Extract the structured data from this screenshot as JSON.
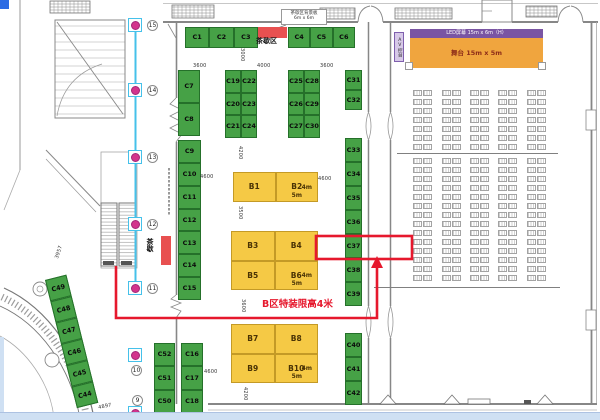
{
  "note_box": {
    "line1": "茶歇区背景板",
    "line2": "6m x 6m"
  },
  "labels": {
    "tea_area": "茶歇区",
    "tea_side": "茶歇",
    "limit": "B区特装限高4米",
    "led": "LED屏幕 15m x 6m（H）",
    "stage": "舞台 15m x 5m",
    "av_console": "AV控台"
  },
  "booth_groups": [
    {
      "id": "c1-3",
      "cells": [
        "C1",
        "C2",
        "C3"
      ]
    },
    {
      "id": "c4-6",
      "cells": [
        "C4",
        "C5",
        "C6"
      ]
    },
    {
      "id": "c7-8",
      "cells": [
        "C7",
        "C8"
      ]
    },
    {
      "id": "c19-24",
      "cells": [
        "C19",
        "C22",
        "C20",
        "C23",
        "C21",
        "C24"
      ]
    },
    {
      "id": "c25-30",
      "cells": [
        "C25",
        "C28",
        "C26",
        "C29",
        "C27",
        "C30"
      ]
    },
    {
      "id": "c31-32",
      "cells": [
        "C31",
        "C32"
      ]
    },
    {
      "id": "c9-15",
      "cells": [
        "C9",
        "C10",
        "C11",
        "C12",
        "C13",
        "C14",
        "C15"
      ]
    },
    {
      "id": "c33-39",
      "cells": [
        "C33",
        "C34",
        "C35",
        "C36",
        "C37",
        "C38",
        "C39"
      ]
    },
    {
      "id": "c40-42",
      "cells": [
        "C40",
        "C41",
        "C42"
      ]
    },
    {
      "id": "c52-50",
      "cells": [
        "C52",
        "C51",
        "C50"
      ]
    },
    {
      "id": "c16-18",
      "cells": [
        "C16",
        "C17",
        "C18"
      ]
    },
    {
      "id": "c49-44",
      "cells": [
        "C49",
        "C48",
        "C47",
        "C46",
        "C45",
        "C44"
      ]
    },
    {
      "id": "b1-2",
      "cells": [
        "B1",
        "B2"
      ],
      "size_labels": [
        "4m",
        "5m"
      ]
    },
    {
      "id": "b3-6",
      "cells": [
        "B3",
        "B4",
        "B5",
        "B6"
      ],
      "size_labels": [
        "4m",
        "5m"
      ]
    },
    {
      "id": "b7-10",
      "cells": [
        "B7",
        "B8",
        "B9",
        "B10"
      ],
      "size_labels": [
        "4m",
        "5m"
      ]
    }
  ],
  "markers": [
    "15",
    "14",
    "13",
    "12",
    "11",
    "10",
    "9"
  ],
  "dimensions": [
    "3600",
    "3000",
    "4000",
    "3600",
    "4200",
    "4600",
    "4600",
    "3500",
    "3600",
    "4600",
    "4200",
    "3957",
    "4897"
  ],
  "seating": {
    "column_groups": 5,
    "chairs_per_group": 2,
    "upper_rows": 7,
    "lower_rows": 14
  },
  "colors": {
    "booth_green": "#46a146",
    "booth_yellow": "#f5c945",
    "highlight_red": "#e6182d",
    "stage_orange": "#f0a53e",
    "led_purple": "#7a55a3",
    "marker_pink": "#d3348c",
    "marker_cyan": "#45c1ea",
    "tea_red": "#e85050",
    "window_blue": "#cfe0f3"
  }
}
